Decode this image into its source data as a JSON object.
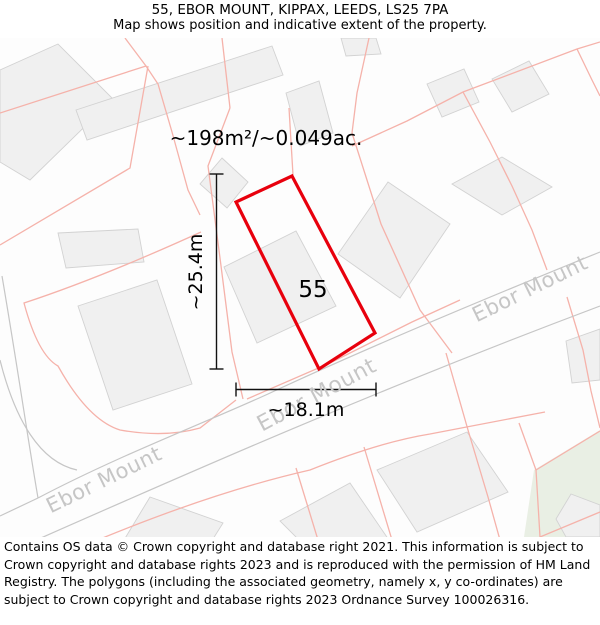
{
  "header": {
    "title": "55, EBOR MOUNT, KIPPAX, LEEDS, LS25 7PA",
    "subtitle": "Map shows position and indicative extent of the property."
  },
  "map": {
    "area_label": "~198m²/~0.049ac.",
    "plot_number": "55",
    "dim_vertical_label": "~25.4m",
    "dim_horizontal_label": "~18.1m",
    "street_name": "Ebor Mount",
    "colors": {
      "map_background": "#fdfdfd",
      "building_fill": "#f0f0f0",
      "building_stroke": "#d2d2d2",
      "parcel_pink": "#f5b2aa",
      "road_gray": "#c6c6c6",
      "street_text_gray": "#c6c6c6",
      "green_area": "#e9efe4",
      "property_red": "#e8000d",
      "dimension_black": "#111111"
    },
    "geometry": {
      "green_areas": [
        "534,470 600,430 600,537 524,537"
      ],
      "buildings": [
        "0,70 58,44 113,99 30,180 0,162",
        "76,110 272,46 283,75 87,140",
        "286,93 319,81 333,133 300,146",
        "427,84 464,69 479,102 442,117",
        "492,79 529,61 549,94 512,112",
        "452,184 502,157 552,187 502,215",
        "566,341 600,329 600,380 572,383",
        "296,231 336,306 257,343 224,267",
        "222,158 248,182 227,208 200,184",
        "157,280 192,384 113,410 78,306",
        "58,233 138,229 144,262 66,268",
        "388,182 450,224 400,298 338,254",
        "467,432 508,492 417,532 377,470",
        "280,521 350,483 393,546 322,563",
        "150,497 223,523 196,566 124,540",
        "556,519 571,494 600,505 600,537 566,537",
        "341,38 376,38 381,54 346,56"
      ],
      "pink_lines": [
        "M0,113 L146,66 L158,84 L172,132 L188,190 L200,215",
        "M125,38 L146,66",
        "M0,245 L130,168 L148,66",
        "M201,232 Q100,278 24,303 Q38,355 58,366 Q88,420 120,430 Q165,438 200,428 L236,400",
        "M230,108 L208,166 L220,258 L232,352 L243,399",
        "M289,108 L293,175",
        "M222,38 L230,108",
        "M369,38 L357,93 L352,133",
        "M352,133 L381,224 L420,310 L452,353",
        "M352,146 L407,121 L463,92 L577,49 L600,42",
        "M463,92 L490,142 L512,186 L532,230 L547,270",
        "M577,49 L592,80 L600,96",
        "M60,556 Q200,495 310,470 Q380,442 430,434 L545,412",
        "M446,353 L468,430 L488,497 L500,540",
        "M296,468 L318,540",
        "M364,447 L392,540",
        "M519,423 L536,470 L540,537",
        "M567,297 L583,350 L591,391 L600,428",
        "M536,470 L600,431",
        "M540,537 L600,512",
        "M247,399 L330,363 L412,322 L460,300"
      ],
      "road_lines": [
        "M38,498 C120,455 200,425 268,394 C330,365 420,325 600,252",
        "M0,556 C150,490 350,400 600,306",
        "M2,276 C18,370 28,440 38,498",
        "M0,360 C15,420 40,462 77,470",
        "M0,516 L38,498"
      ],
      "red_polygon": "292,176 375,333 319,369 236,202",
      "dimension_segments": [
        {
          "x1": 216.5,
          "y1": 174,
          "x2": 216.5,
          "y2": 369
        },
        {
          "x1": 209.5,
          "y1": 174,
          "x2": 223.5,
          "y2": 174
        },
        {
          "x1": 209.5,
          "y1": 369,
          "x2": 223.5,
          "y2": 369
        },
        {
          "x1": 236,
          "y1": 389.5,
          "x2": 376,
          "y2": 389.5
        },
        {
          "x1": 236,
          "y1": 382.5,
          "x2": 236,
          "y2": 396.5
        },
        {
          "x1": 376,
          "y1": 382.5,
          "x2": 376,
          "y2": 396.5
        }
      ]
    }
  },
  "footer": {
    "text": "Contains OS data © Crown copyright and database right 2021. This information is subject to Crown copyright and database rights 2023 and is reproduced with the permission of HM Land Registry. The polygons (including the associated geometry, namely x, y co-ordinates) are subject to Crown copyright and database rights 2023 Ordnance Survey 100026316."
  }
}
